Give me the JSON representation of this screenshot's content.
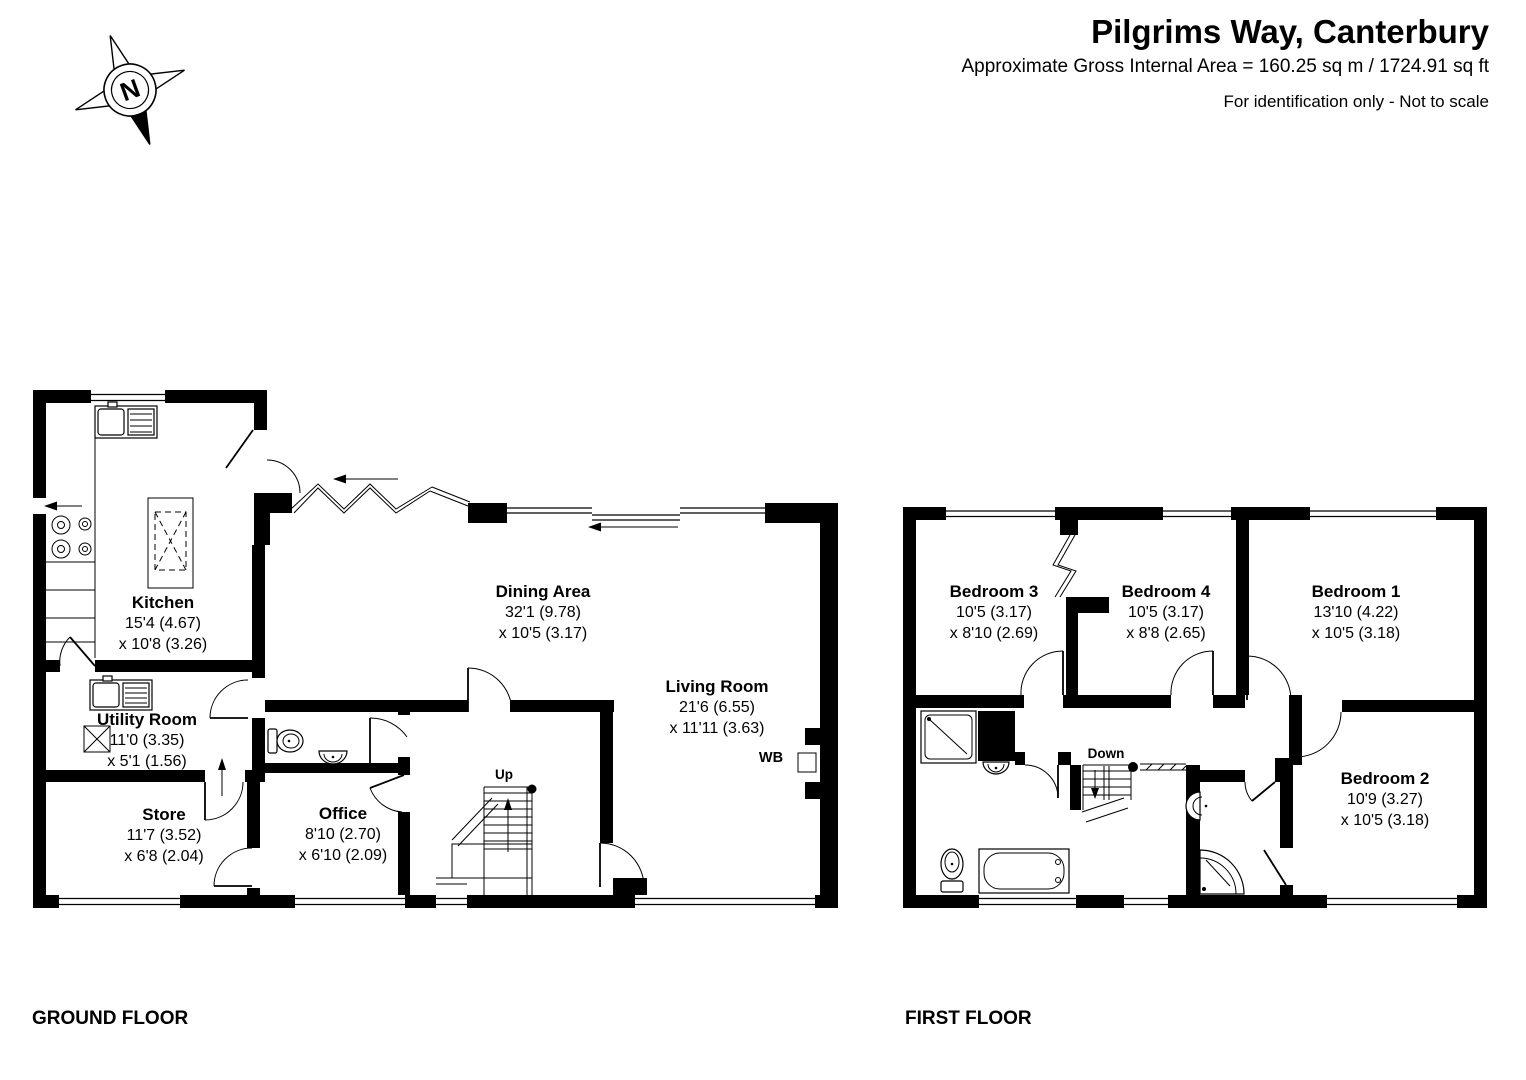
{
  "header": {
    "title": "Pilgrims Way, Canterbury",
    "subtitle": "Approximate Gross Internal Area = 160.25 sq m / 1724.91 sq ft",
    "note": "For identification only - Not to scale"
  },
  "compass": {
    "north_label": "N"
  },
  "ground_floor": {
    "title": "GROUND FLOOR",
    "rooms": {
      "kitchen": {
        "name": "Kitchen",
        "dim1": "15'4 (4.67)",
        "dim2": "x 10'8 (3.26)"
      },
      "utility_room": {
        "name": "Utility Room",
        "dim1": "11'0 (3.35)",
        "dim2": "x 5'1 (1.56)"
      },
      "store": {
        "name": "Store",
        "dim1": "11'7 (3.52)",
        "dim2": "x 6'8 (2.04)"
      },
      "office": {
        "name": "Office",
        "dim1": "8'10 (2.70)",
        "dim2": "x 6'10 (2.09)"
      },
      "dining_area": {
        "name": "Dining Area",
        "dim1": "32'1 (9.78)",
        "dim2": "x 10'5 (3.17)"
      },
      "living_room": {
        "name": "Living Room",
        "dim1": "21'6 (6.55)",
        "dim2": "x 11'11 (3.63)"
      }
    },
    "labels": {
      "stairs_up": "Up",
      "wood_burner": "WB"
    }
  },
  "first_floor": {
    "title": "FIRST FLOOR",
    "rooms": {
      "bedroom_1": {
        "name": "Bedroom 1",
        "dim1": "13'10 (4.22)",
        "dim2": "x 10'5 (3.18)"
      },
      "bedroom_2": {
        "name": "Bedroom 2",
        "dim1": "10'9 (3.27)",
        "dim2": "x 10'5 (3.18)"
      },
      "bedroom_3": {
        "name": "Bedroom 3",
        "dim1": "10'5 (3.17)",
        "dim2": "x 8'10 (2.69)"
      },
      "bedroom_4": {
        "name": "Bedroom 4",
        "dim1": "10'5 (3.17)",
        "dim2": "x 8'8 (2.65)"
      }
    },
    "labels": {
      "stairs_down": "Down"
    }
  },
  "colors": {
    "ink": "#000000",
    "paper": "#ffffff"
  }
}
